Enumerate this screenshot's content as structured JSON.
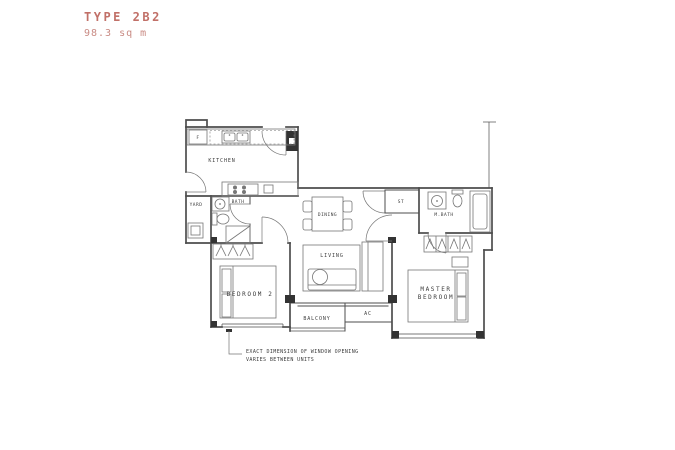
{
  "colors": {
    "accent": "#c17068",
    "accent2": "#c98b84",
    "wall": "#4d4d4d",
    "fixture": "#767676",
    "label": "#3c3c3c",
    "column": "#333333"
  },
  "header": {
    "title": "TYPE 2B2",
    "area": "98.3 sq m"
  },
  "unit": {
    "rooms": {
      "kitchen": "KITCHEN",
      "yard": "YARD",
      "bath": "BATH",
      "dining": "DINING",
      "living": "LIVING",
      "store": "ST",
      "master_bath": "M.BATH",
      "bedroom2": "BEDROOM 2",
      "master_line1": "MASTER",
      "master_line2": "BEDROOM",
      "balcony": "BALCONY",
      "ac_ledge": "AC",
      "fridge": "F"
    },
    "annotation": {
      "line1": "EXACT DIMENSION OF WINDOW OPENING",
      "line2": "VARIES BETWEEN UNITS"
    }
  }
}
